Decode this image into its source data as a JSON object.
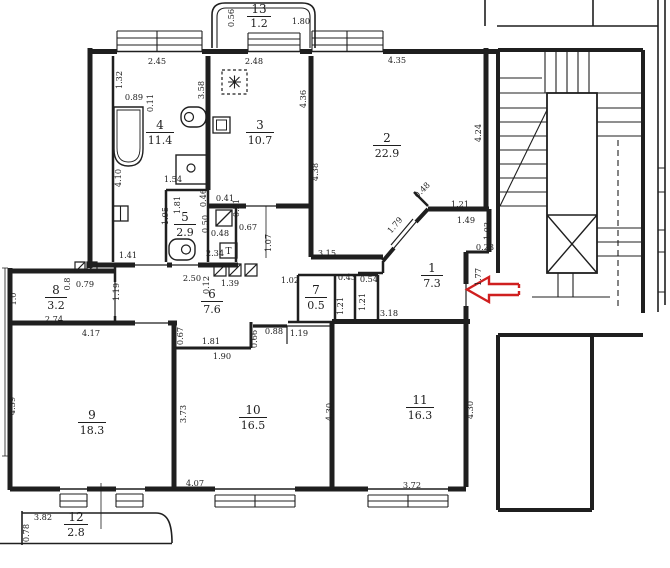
{
  "plan": {
    "ink": "#1f1f1f",
    "paper": "#ffffff",
    "arrow_color": "#cf1f1f",
    "vent_label": "T",
    "rooms": [
      {
        "number": "1",
        "area": "7.3"
      },
      {
        "number": "2",
        "area": "22.9"
      },
      {
        "number": "3",
        "area": "10.7"
      },
      {
        "number": "4",
        "area": "11.4"
      },
      {
        "number": "5",
        "area": "2.9"
      },
      {
        "number": "6",
        "area": "7.6"
      },
      {
        "number": "7",
        "area": "0.5"
      },
      {
        "number": "8",
        "area": "3.2"
      },
      {
        "number": "9",
        "area": "18.3"
      },
      {
        "number": "10",
        "area": "16.5"
      },
      {
        "number": "11",
        "area": "16.3"
      },
      {
        "number": "12",
        "area": "2.8"
      },
      {
        "number": "13",
        "area": "1.2"
      }
    ],
    "dims": [
      {
        "text": "0.56"
      },
      {
        "text": "1.80"
      },
      {
        "text": "2.45"
      },
      {
        "text": "1.32"
      },
      {
        "text": "0.89"
      },
      {
        "text": "0.11"
      },
      {
        "text": "3.58"
      },
      {
        "text": "2.48"
      },
      {
        "text": "4.36"
      },
      {
        "text": "4.35"
      },
      {
        "text": "4.24"
      },
      {
        "text": "4.38"
      },
      {
        "text": "4.10"
      },
      {
        "text": "1.54"
      },
      {
        "text": "1.95"
      },
      {
        "text": "1.41"
      },
      {
        "text": "1.81"
      },
      {
        "text": "0.46"
      },
      {
        "text": "0.41"
      },
      {
        "text": "0.21"
      },
      {
        "text": "0.50"
      },
      {
        "text": "0.48"
      },
      {
        "text": "0.67"
      },
      {
        "text": "2.34"
      },
      {
        "text": "1.07"
      },
      {
        "text": "3.15"
      },
      {
        "text": "0.48"
      },
      {
        "text": "1.21"
      },
      {
        "text": "1.49"
      },
      {
        "text": "1.79"
      },
      {
        "text": "1.03"
      },
      {
        "text": "0.23"
      },
      {
        "text": "1.77"
      },
      {
        "text": "0.43"
      },
      {
        "text": "0.54"
      },
      {
        "text": "1.21"
      },
      {
        "text": "1.21"
      },
      {
        "text": "3.18"
      },
      {
        "text": "1.02"
      },
      {
        "text": "2.50"
      },
      {
        "text": "0.12"
      },
      {
        "text": "1.39"
      },
      {
        "text": "1.19"
      },
      {
        "text": "0.8"
      },
      {
        "text": "0.79"
      },
      {
        "text": "1.0"
      },
      {
        "text": "2.74"
      },
      {
        "text": "4.17"
      },
      {
        "text": "4.39"
      },
      {
        "text": "0.67"
      },
      {
        "text": "1.81"
      },
      {
        "text": "1.90"
      },
      {
        "text": "0.66"
      },
      {
        "text": "0.88"
      },
      {
        "text": "1.19"
      },
      {
        "text": "3.73"
      },
      {
        "text": "4.07"
      },
      {
        "text": "4.30"
      },
      {
        "text": "4.30"
      },
      {
        "text": "3.72"
      },
      {
        "text": "3.82"
      },
      {
        "text": "0.78"
      }
    ]
  }
}
